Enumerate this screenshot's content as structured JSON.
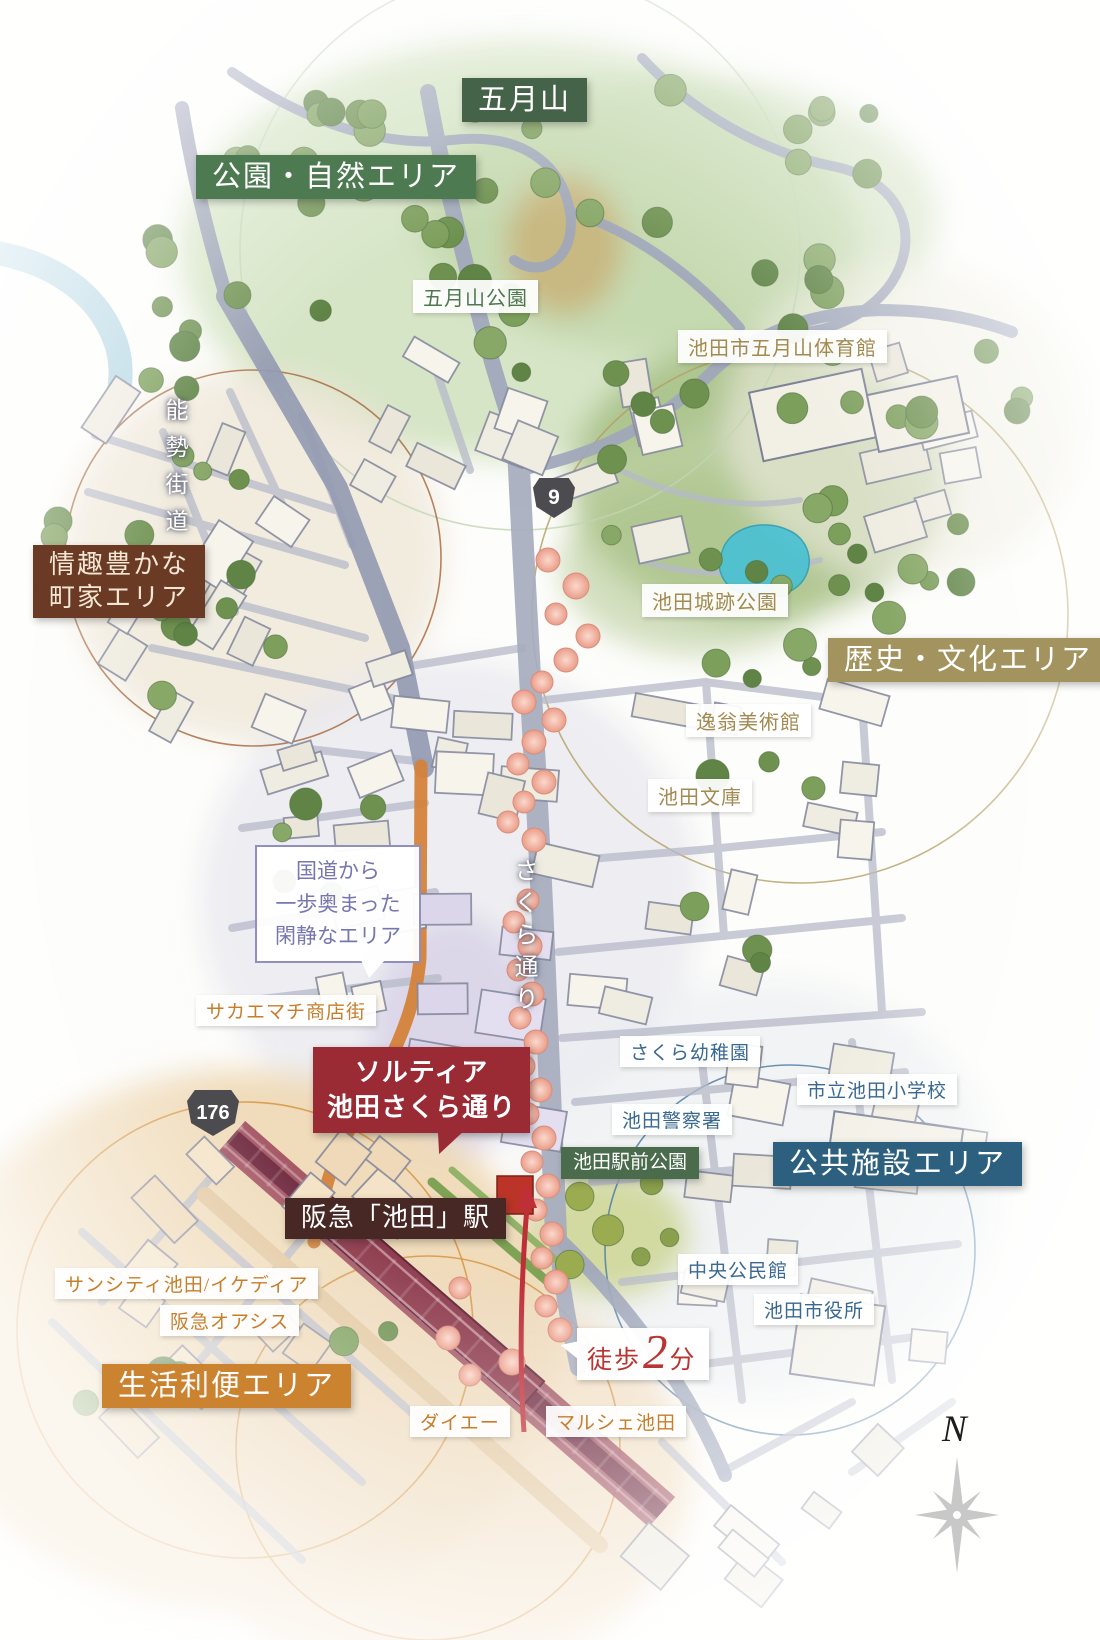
{
  "regions": {
    "satsukiyama": "五月山",
    "park_nature": "公園・自然エリア",
    "machiya_line1": "情趣豊かな",
    "machiya_line2": "町家エリア",
    "history_culture": "歴史・文化エリア",
    "public_facility": "公共施設エリア",
    "life_convenience": "生活利便エリア"
  },
  "pois": {
    "satsukiyama_park": "五月山公園",
    "gymnasium": "池田市五月山体育館",
    "castle_park": "池田城跡公園",
    "itsuo_museum": "逸翁美術館",
    "ikeda_bunko": "池田文庫",
    "sakura_kindergarten": "さくら幼稚園",
    "police_station": "池田警察署",
    "elementary_school": "市立池田小学校",
    "ekimae_park": "池田駅前公園",
    "community_center": "中央公民館",
    "city_hall": "池田市役所",
    "suncity": "サンシティ池田/イケディア",
    "hankyu_oasis": "阪急オアシス",
    "daiei": "ダイエー",
    "marche_ikeda": "マルシェ池田"
  },
  "roads": {
    "nose_kaido": "能勢街道",
    "sakura_dori": "さくら通り",
    "sakaemachi": "サカエマチ商店街",
    "route_9": "9",
    "route_176": "176"
  },
  "station": {
    "label": "阪急「池田」駅"
  },
  "property": {
    "line1": "ソルティア",
    "line2": "池田さくら通り"
  },
  "note": {
    "line1": "国道から",
    "line2": "一歩奥まった",
    "line3": "閑静なエリア"
  },
  "walk": {
    "prefix": "徒歩",
    "minutes": "2",
    "unit": "分"
  },
  "compass": {
    "north": "N"
  },
  "colors": {
    "area_green": "#4d7a51",
    "area_dark_green": "#456349",
    "area_brown": "#6a3a25",
    "area_tan": "#a3945f",
    "area_blue": "#2d607f",
    "area_orange": "#cc8330",
    "property_red": "#9a2a33",
    "station_brown": "#472824",
    "walk_red": "#b93531",
    "poi_blue": "#3a6890",
    "poi_tan": "#a28a50",
    "poi_orange": "#c67e2b",
    "poi_green": "#50784f"
  }
}
